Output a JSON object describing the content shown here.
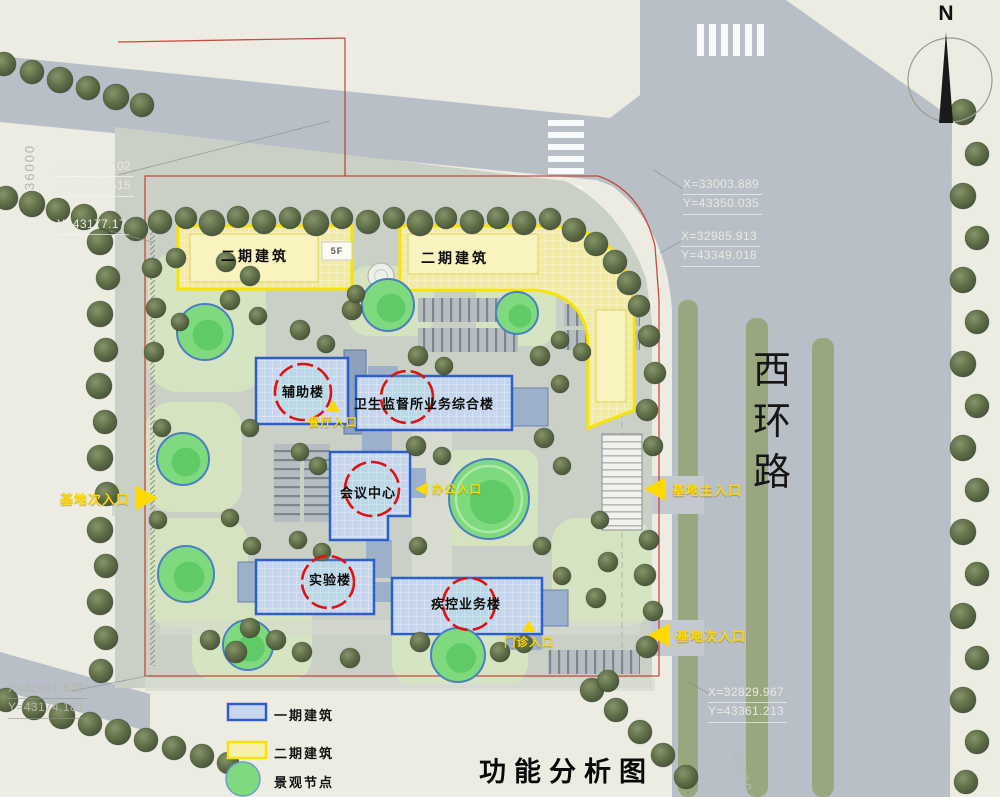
{
  "title": "功能分析图",
  "compass": {
    "north_label": "N"
  },
  "road": {
    "name_chars": [
      "西",
      "环",
      "路"
    ]
  },
  "dimensions": {
    "west_edge": "36000",
    "southeast_edge": "60000"
  },
  "coordinates": {
    "nw": {
      "x": "X=33010.102",
      "y": "Y=43177.515"
    },
    "nw2": {
      "y": "Y=43177.17"
    },
    "ne1": {
      "x": "X=33003.889",
      "y": "Y=43350.035"
    },
    "ne2": {
      "x": "X=32985.913",
      "y": "Y=43349.018"
    },
    "sw": {
      "x": "X=32831.522",
      "y": "Y=43174.181"
    },
    "se": {
      "x": "X=32829.967",
      "y": "Y=43361.213"
    }
  },
  "buildings": {
    "phase2_label_left": "二期建筑",
    "phase2_label_right": "二期建筑",
    "floor_tag": "5F",
    "auxiliary": "辅助楼",
    "health_supervision": "卫生监督所业务综合楼",
    "conference": "会议中心",
    "laboratory": "实验楼",
    "cdc": "疾控业务楼"
  },
  "entrances": {
    "west_secondary": "基地次入口",
    "east_main": "基地主入口",
    "east_secondary": "基地次入口",
    "canteen": "餐厅入口",
    "office": "办公入口",
    "clinic": "门诊入口"
  },
  "legend": {
    "items": [
      {
        "label": "一期建筑",
        "type": "phase1-building"
      },
      {
        "label": "二期建筑",
        "type": "phase2-building"
      },
      {
        "label": "景观节点",
        "type": "landscape-node"
      }
    ]
  },
  "colors": {
    "phase1_border": "#2e5fc9",
    "phase1_fill": "#c5d6ee",
    "phase2_border": "#f7e400",
    "phase2_fill": "#f2eba6",
    "node_fill": "#7fd97f",
    "node_ring": "#4c7fc2",
    "entrance_yellow": "#ffd900",
    "red_circle": "#de1212",
    "red_boundary": "#c23b2e",
    "road_gray": "#b9bfc6"
  }
}
